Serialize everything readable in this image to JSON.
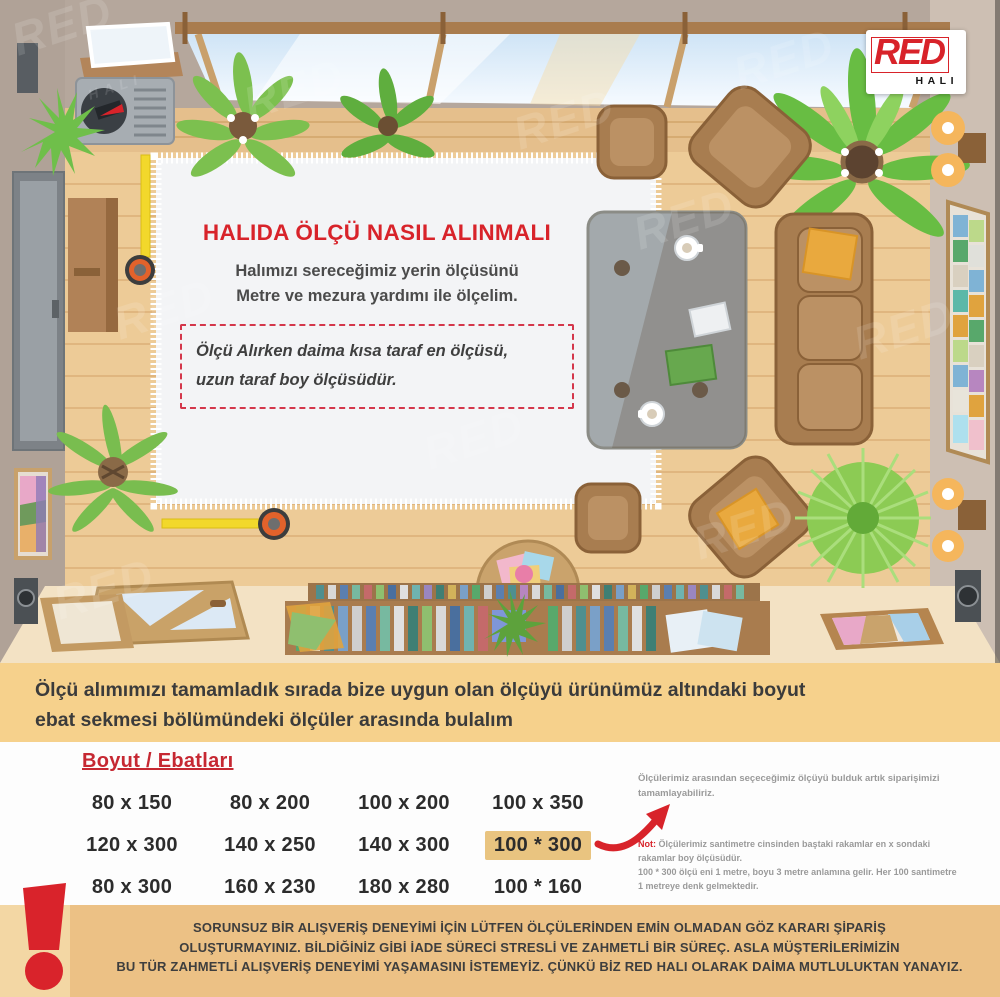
{
  "logo": {
    "red": "RED",
    "hali": "HALI"
  },
  "watermark": {
    "text": "RED",
    "sub": "HALI"
  },
  "carpet": {
    "title": "HALIDA ÖLÇÜ NASIL ALINMALI",
    "body_line1": "Halımızı sereceğimiz yerin ölçüsünü",
    "body_line2": "Metre ve mezura yardımı ile ölçelim.",
    "note_line1": "Ölçü Alırken daima kısa taraf en ölçüsü,",
    "note_line2": "uzun taraf boy ölçüsüdür."
  },
  "intro": {
    "line1": "Ölçü alımımızı tamamladık sırada bize uygun olan ölçüyü ürünümüz altındaki boyut",
    "line2": "ebat sekmesi bölümündeki ölçüler arasında bulalım"
  },
  "sizes": {
    "heading": "Boyut / Ebatları",
    "rows": [
      [
        "80 x 150",
        "80 x 200",
        "100 x 200",
        "100 x 350"
      ],
      [
        "120 x 300",
        "140 x 250",
        "140 x 300",
        "100 * 300"
      ],
      [
        "80 x 300",
        "160 x 230",
        "180 x 280",
        "100 * 160"
      ]
    ],
    "highlighted_value": "100 * 300"
  },
  "notes": {
    "p1_line1": "Ölçülerimiz arasından seçeceğimiz ölçüyü bulduk artık siparişimizi",
    "p1_line2": "tamamlayabiliriz.",
    "note_label": "Not:",
    "n1": "Ölçülerimiz santimetre cinsinden baştaki rakamlar en x sondaki",
    "n2": "rakamlar boy ölçüsüdür.",
    "n3": "100 * 300 ölçü eni 1 metre, boyu 3 metre anlamına gelir. Her 100 santimetre",
    "n4": "1 metreye denk gelmektedir."
  },
  "warning": {
    "line1": "SORUNSUZ BİR ALIŞVERİŞ DENEYİMİ İÇİN LÜTFEN ÖLÇÜLERİNDEN EMİN OLMADAN GÖZ KARARI ŞİPARİŞ",
    "line2": "OLUŞTURMAYINIZ. BİLDİĞİNİZ GİBİ İADE SÜRECİ STRESLİ VE ZAHMETLİ BİR SÜREÇ. ASLA MÜŞTERİLERİMİZİN",
    "line3": "BU TÜR ZAHMETLİ ALIŞVERİŞ DENEYİMİ YAŞAMASINI İSTEMEYİZ. ÇÜNKÜ BİZ RED HALI OLARAK DAİMA MUTLULUKTAN YANAYIZ."
  },
  "icons": {
    "warning": "exclamation-icon",
    "size_pointer": "curved-arrow-icon"
  },
  "colors": {
    "brand_red": "#d8232a",
    "band_sand": "#f6d18c",
    "warn_sand": "#ecc185",
    "highlight": "#e9c480",
    "text_dark": "#3b3b3b",
    "note_gray": "#9a9a9a"
  }
}
